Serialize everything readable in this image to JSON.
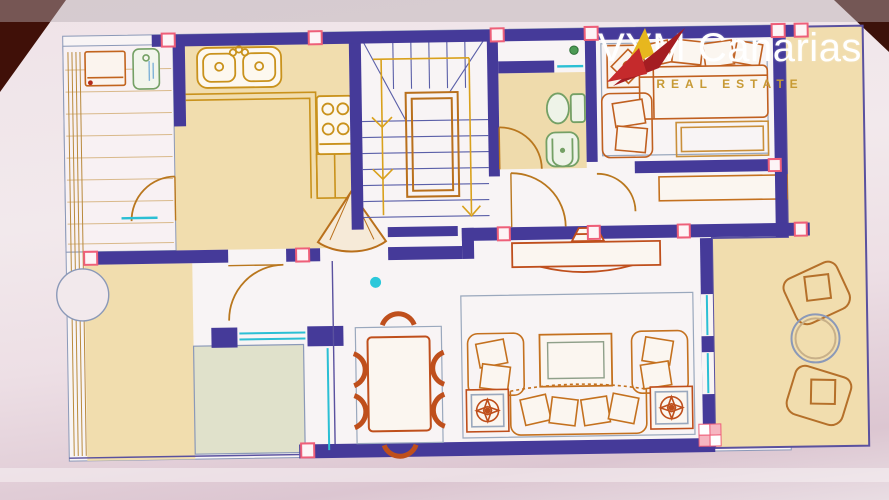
{
  "photo": {
    "description": "photo of a printed real-estate floor plan, slightly rotated, dark backdrop visible at top corners",
    "corner_color": "#401008",
    "paper_color": "#efe3e8"
  },
  "watermark": {
    "title": "VYM Canarias",
    "subtitle": "REAL ESTATE",
    "title_color": "#ffffff",
    "subtitle_color": "#c79a35",
    "logo": {
      "name": "vym-swoosh-logo",
      "colors": [
        "#a41d22",
        "#c52a2c",
        "#e7b71e"
      ]
    }
  },
  "palette": {
    "wall_navy": "#453a99",
    "floor_cream": "#f1ddae",
    "floor_white": "#f8f4f5",
    "floor_green_grey": "#e0e1cb",
    "kitchen_gold": "#c9921c",
    "furniture_orange": "#c4711f",
    "furniture_red_orange": "#bf4f1c",
    "fixture_green": "#74a065",
    "window_teal": "#2bbfd4",
    "corner_marker_pink": "#ee5f79",
    "line_blue_grey": "#8b99b8",
    "cyan_dot": "#2cc8da"
  },
  "rooms": [
    {
      "name": "utility-terrace",
      "floor": "white-striped"
    },
    {
      "name": "kitchen",
      "floor": "cream"
    },
    {
      "name": "staircase",
      "floor": "white"
    },
    {
      "name": "bathroom",
      "floor": "cream"
    },
    {
      "name": "bedroom",
      "floor": "white"
    },
    {
      "name": "hallway",
      "floor": "white"
    },
    {
      "name": "dining-area",
      "floor": "white"
    },
    {
      "name": "living-room",
      "floor": "white"
    },
    {
      "name": "right-terrace",
      "floor": "cream"
    },
    {
      "name": "bottom-left-terrace",
      "floor": "cream"
    },
    {
      "name": "garden-patch",
      "floor": "green-grey"
    }
  ],
  "furniture": [
    {
      "name": "washing-machine"
    },
    {
      "name": "utility-sink"
    },
    {
      "name": "double-kitchen-sink"
    },
    {
      "name": "cooktop"
    },
    {
      "name": "kitchen-counter"
    },
    {
      "name": "corner-fan-door"
    },
    {
      "name": "stair-flight-with-arrows"
    },
    {
      "name": "toilet"
    },
    {
      "name": "bidet"
    },
    {
      "name": "plant-dot"
    },
    {
      "name": "double-bed-with-pillows"
    },
    {
      "name": "bedroom-armchair"
    },
    {
      "name": "bedside-rug"
    },
    {
      "name": "decorative-square-rug"
    },
    {
      "name": "wardrobe"
    },
    {
      "name": "sideboard-with-lamp"
    },
    {
      "name": "dining-table"
    },
    {
      "name": "dining-chair",
      "count": 6
    },
    {
      "name": "tv-unit"
    },
    {
      "name": "living-armchair",
      "count": 2
    },
    {
      "name": "sofa"
    },
    {
      "name": "lamp-side-table",
      "count": 2
    },
    {
      "name": "terrace-chair",
      "count": 2
    },
    {
      "name": "terrace-round-table"
    },
    {
      "name": "door-swing-arc",
      "count": 5
    },
    {
      "name": "window-segment-teal",
      "count": 6
    },
    {
      "name": "pink-corner-marker",
      "count": 14
    },
    {
      "name": "cyan-location-dot"
    }
  ]
}
